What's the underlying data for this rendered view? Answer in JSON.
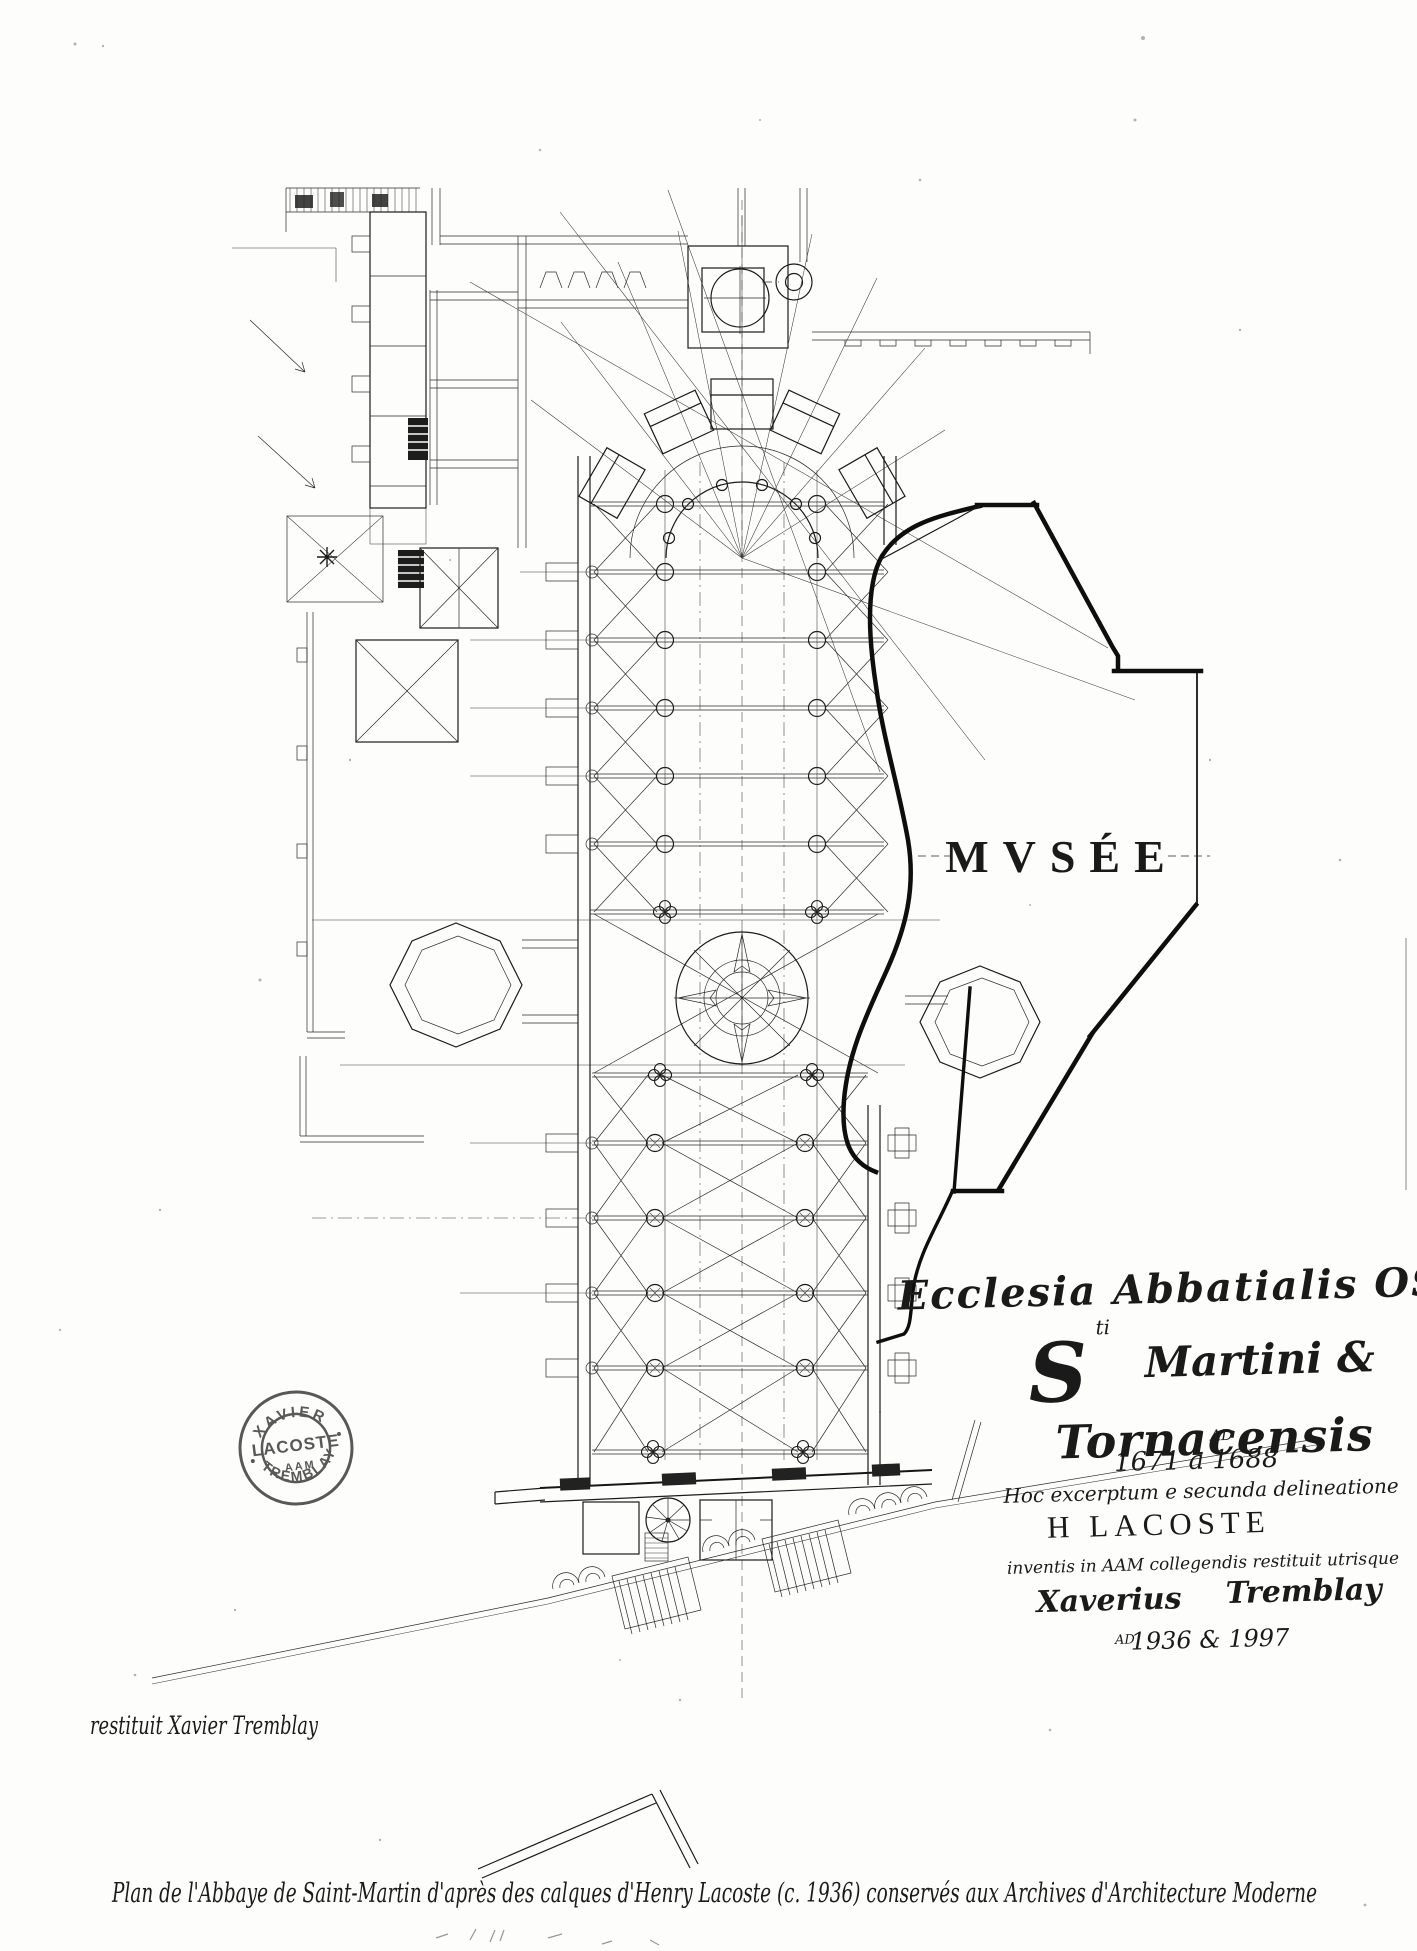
{
  "page": {
    "paper_color": "#fdfdfb",
    "ink_color": "#1b1b1b",
    "stamp_ink_color": "#474747"
  },
  "plan": {
    "museum_label": "MVSÉE"
  },
  "cartouche": {
    "line1": "Ecclesia Abbatialis OSB",
    "line2_initial": "S",
    "line2_sup": "ti",
    "line2_rest": "Martini &",
    "line3": "Tornacensis",
    "anno_domini_sup": "AD",
    "dates_original": "1671 à 1688",
    "line5": "Hoc excerptum e secunda delineatione",
    "author": "H LACOSTE",
    "line7": "inventis in AAM collegendis restituit utrisque",
    "restorer_first": "Xaverius",
    "restorer_last": "Tremblay",
    "dates_restitution_sup": "AD",
    "dates_restitution": "1936 & 1997"
  },
  "stamp": {
    "arc_top": "XAVIER",
    "center": "LACOSTE",
    "center_sub": "AAM",
    "arc_bottom": "TREMBLAY"
  },
  "annotations": {
    "restituit": "restituit  Xavier Tremblay",
    "caption": "Plan de l'Abbaye de Saint-Martin  d'après des calques  d'Henry Lacoste  (c. 1936) conservés  aux Archives  d'Architecture  Moderne"
  }
}
